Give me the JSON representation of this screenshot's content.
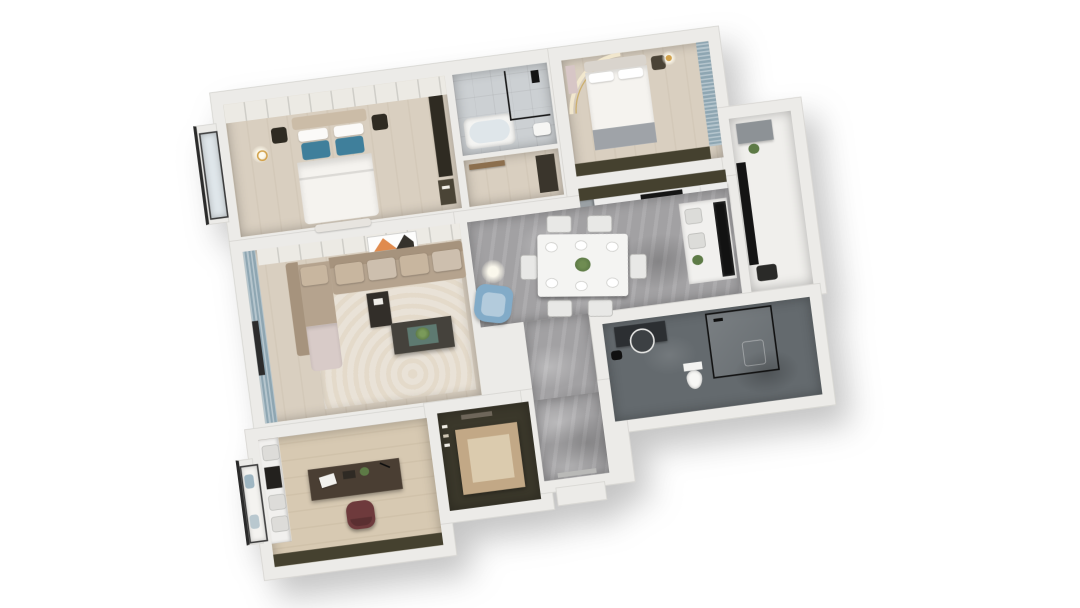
{
  "scene": {
    "type": "3d-floorplan-render",
    "description": "Top-down axonometric dollhouse render of a three-bedroom apartment, white cut walls on a white background, rotated slightly counter-clockwise",
    "background": "#ffffff",
    "rotation_deg": -7.5,
    "visible_text": ""
  },
  "palette": {
    "bg": "#ffffff",
    "wall": "#ecebe8",
    "wallEdge": "#d6d5d1",
    "woodLight": "#d9cfc0",
    "woodStudy": "#d7c9b2",
    "marble": "#a2a1a3",
    "tileLight": "#ccd0d3",
    "tileDark": "#646a6e",
    "olive": "#45412f",
    "wardrobe": "#eceae4",
    "curtain": "#8ea6b2",
    "rug": "#e9e2d7",
    "sofa": "#b5a38e",
    "sofaBack": "#a6937d",
    "sofaLight": "#c8b69f",
    "sofaPink": "#d8cbc8",
    "pillowBlue": "#3f7f9b",
    "armBlue": "#82abc8",
    "armBlueLight": "#b3cbdc",
    "maroon": "#6e3a3c",
    "counter": "#ececeb",
    "cabinetGray": "#9aa0a4",
    "dark": "#2f2b22",
    "black": "#161616",
    "bed": "#f5f3ef",
    "headboard": "#cbbca7",
    "grayThrow": "#9fa3a8",
    "tan": "#c2a886",
    "tanLight": "#dbcbae",
    "artOrange": "#e08b4e",
    "plant": "#5d7a46",
    "gold": "#d2a24c",
    "glass": "#dfe6ea"
  },
  "rooms": [
    {
      "id": "master-bedroom",
      "floor": "light-wood",
      "furniture": [
        "double-bed",
        "blue-pillows",
        "nightstands",
        "wardrobe-run",
        "tv-panel",
        "bay-window",
        "pendant-light",
        "foot-bench"
      ]
    },
    {
      "id": "bathroom-top",
      "floor": "light-gray-tile",
      "furniture": [
        "bathtub",
        "glass-shower-screen",
        "black-shower-fixture",
        "sink"
      ]
    },
    {
      "id": "vestibule",
      "floor": "light-wood",
      "furniture": [
        "door-leaf",
        "tall-cabinet"
      ]
    },
    {
      "id": "bedroom-2",
      "floor": "light-wood",
      "furniture": [
        "double-bed",
        "nightstand",
        "gold-lamp",
        "cove-arc-light",
        "curtains",
        "wardrobe-band"
      ]
    },
    {
      "id": "kitchen",
      "floor": "gray-tile",
      "furniture": [
        "upper-cabinet-band",
        "counter",
        "gas-cooktop",
        "gray-cabinets",
        "sink-counter"
      ]
    },
    {
      "id": "dining-hall",
      "floor": "gray-marble",
      "furniture": [
        "dining-table",
        "chairs-x6",
        "plates",
        "plant-centerpiece",
        "shelf-cabinet",
        "black-window-panel",
        "floor-lamp-glow"
      ]
    },
    {
      "id": "living-room",
      "floor": "light-wood",
      "furniture": [
        "l-shaped-sofa",
        "seat-cushions",
        "side-table",
        "coffee-table",
        "plant",
        "area-rug",
        "blue-armchair",
        "curtains",
        "window",
        "leaning-artwork",
        "media-wall"
      ]
    },
    {
      "id": "balcony",
      "floor": "white",
      "furniture": [
        "black-glass-panel",
        "low-cabinet",
        "plant",
        "dark-unit"
      ]
    },
    {
      "id": "bathroom-main",
      "floor": "dark-gray-tile",
      "furniture": [
        "vanity",
        "round-mirror",
        "stool",
        "glass-shower",
        "toilet"
      ]
    },
    {
      "id": "study",
      "floor": "light-wood",
      "furniture": [
        "desk",
        "laptop",
        "books",
        "desk-chair",
        "bookshelf",
        "tv-niche",
        "window-seat",
        "wardrobe-band"
      ]
    },
    {
      "id": "walk-in-closet",
      "floor": "tan-carpet",
      "furniture": [
        "wardrobe-surround",
        "hanging-clothes",
        "rug"
      ]
    },
    {
      "id": "entry",
      "floor": "gray-marble",
      "furniture": [
        "threshold",
        "outside-landing"
      ]
    }
  ]
}
